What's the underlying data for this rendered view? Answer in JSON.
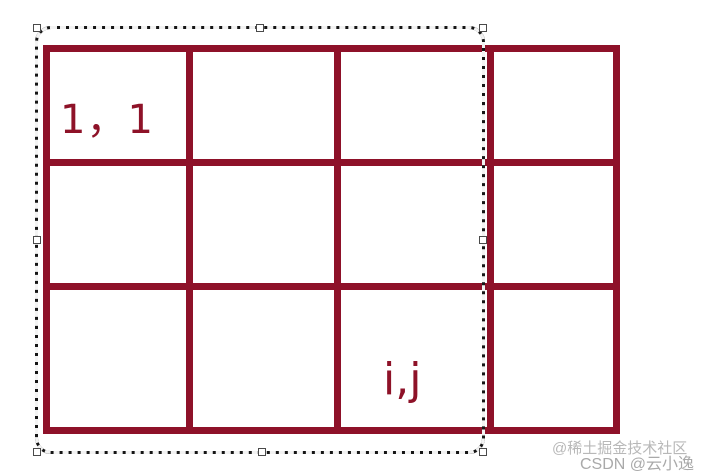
{
  "artboard": {
    "background": "#ffffff"
  },
  "diagram": {
    "grid": {
      "rows": 3,
      "columns": 4,
      "line_color": "#8e1129"
    },
    "label_color": "#8e1228",
    "cell_labels": [
      {
        "id": "row1-col1",
        "text": "1，1"
      },
      {
        "id": "rowi-colj",
        "text": "i,j"
      }
    ]
  },
  "selection": {
    "style": "marching-ants-rounded-rect",
    "border_color": "#151515",
    "handle_fill": "#ffffff",
    "handle_count": 8
  },
  "watermarks": [
    {
      "text": "@稀土掘金技术社区",
      "color": "#b8b8b8"
    },
    {
      "text": "CSDN @云小逸",
      "color": "#9b9b9b"
    }
  ]
}
